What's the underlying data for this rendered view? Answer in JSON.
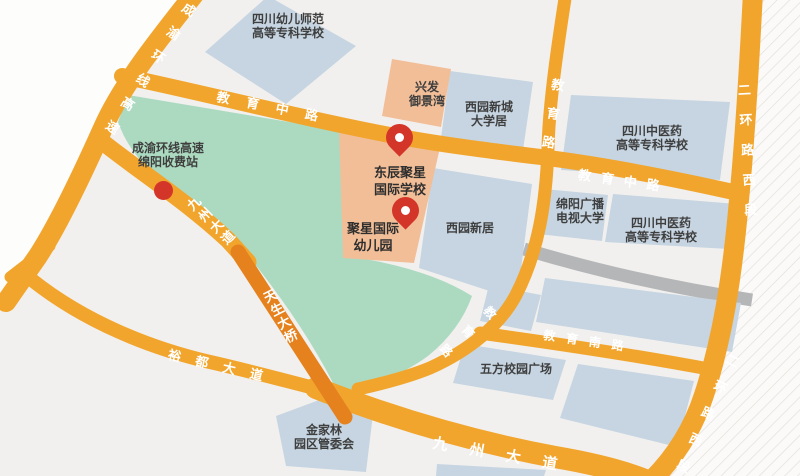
{
  "map": {
    "colors": {
      "background": "#f1f0ee",
      "road_orange": "#f2a52d",
      "bridge_orange": "#e5821e",
      "road_gray": "#b5b6b8",
      "park_green": "#acdac1",
      "building_blue": "#c6d5e1",
      "building_peach": "#f2be98",
      "marker_red": "#d43529",
      "road_label_text": "#ffffff",
      "place_label_text": "#3f3f3f"
    },
    "road_labels": {
      "chengyu_expressway": "成渝环线高速",
      "jiaoyu_middle_west": "教育中路",
      "jiaoyu_middle_east": "教育中路",
      "jiaoyu_road_north": "教育路",
      "jiaoyu_road_south_leg": "教育路",
      "jiaoyu_south_road": "教育南路",
      "erhuan_west_upper": "二环路西段",
      "erhuan_west_lower": "二环路西段",
      "jiuzhou_avenue_upper": "九州大道",
      "jiuzhou_avenue_lower": "九州大道",
      "tiansheng_bridge": "天生大桥",
      "yudu_avenue": "裕都大道"
    },
    "places": {
      "toll_station": {
        "line1": "成渝环线高速",
        "line2": "绵阳收费站"
      },
      "preschool_college": {
        "line1": "四川幼儿师范",
        "line2": "高等专科学校"
      },
      "xingfa_yujingwan": {
        "line1": "兴发",
        "line2": "御景湾"
      },
      "xiyuan_xincheng": {
        "line1": "西园新城",
        "line2": "大学居"
      },
      "tcm_college_north": {
        "line1": "四川中医药",
        "line2": "高等专科学校"
      },
      "radio_tv_university": {
        "line1": "绵阳广播",
        "line2": "电视大学"
      },
      "tcm_college_south": {
        "line1": "四川中医药",
        "line2": "高等专科学校"
      },
      "xiyuan_xinju": {
        "line1": "西园新居"
      },
      "wufang_plaza": {
        "line1": "五方校园广场"
      },
      "jinjialin_committee": {
        "line1": "金家林",
        "line2": "园区管委会"
      }
    },
    "markers": {
      "school_pin": {
        "line1": "东辰聚星",
        "line2": "国际学校"
      },
      "kindergarten_pin": {
        "line1": "聚星国际",
        "line2": "幼儿园"
      }
    }
  }
}
